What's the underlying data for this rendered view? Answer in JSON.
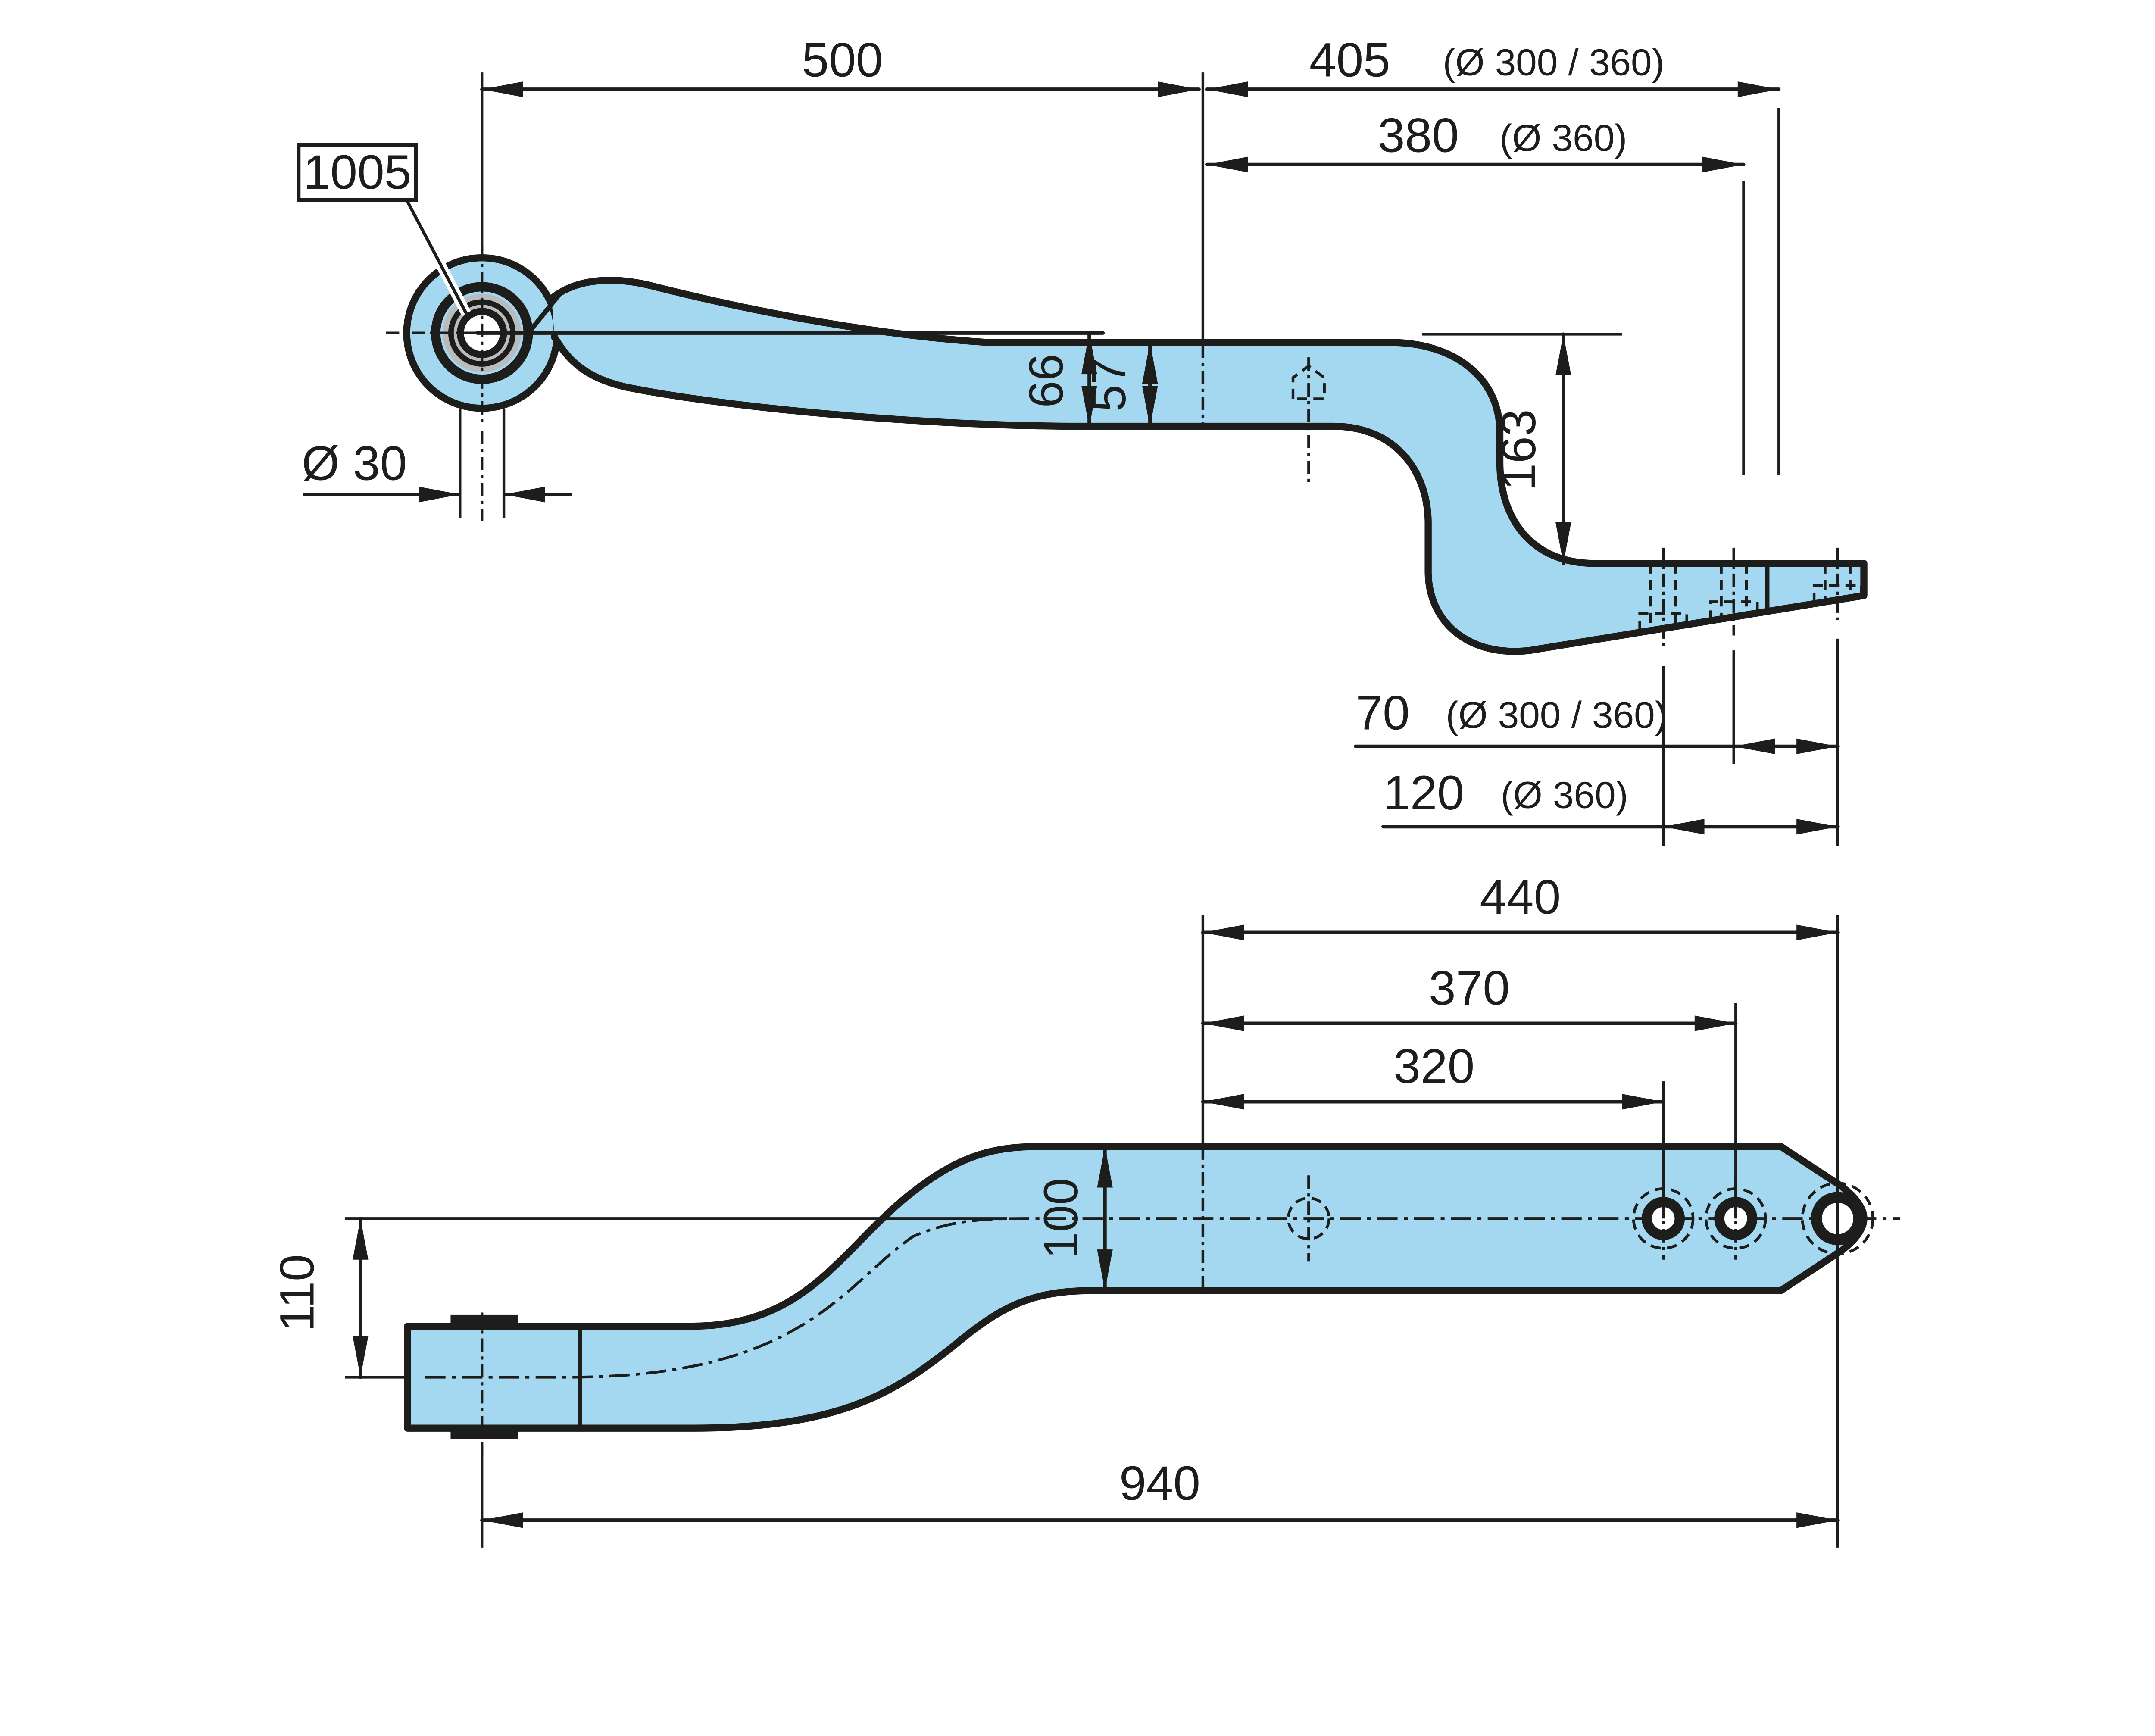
{
  "drawing": {
    "callout": {
      "part_number": "1005"
    },
    "side_view": {
      "dim_500": "500",
      "dim_405": "405",
      "dim_405_note": "(Ø 300 / 360)",
      "dim_380": "380",
      "dim_380_note": "(Ø 360)",
      "dim_eye_bore": "Ø 30",
      "dim_66": "66",
      "dim_57": "57",
      "dim_163": "163",
      "dim_70": "70",
      "dim_70_note": "(Ø 300 / 360)",
      "dim_120": "120",
      "dim_120_note": "(Ø 360)"
    },
    "bottom_view": {
      "dim_440": "440",
      "dim_370": "370",
      "dim_320": "320",
      "dim_100": "100",
      "dim_110": "110",
      "dim_940": "940"
    },
    "colors": {
      "part_fill": "#a3d8f0",
      "outline": "#1d1d1b",
      "bushing_grey": "#b9bcbe",
      "background": "#ffffff"
    }
  }
}
